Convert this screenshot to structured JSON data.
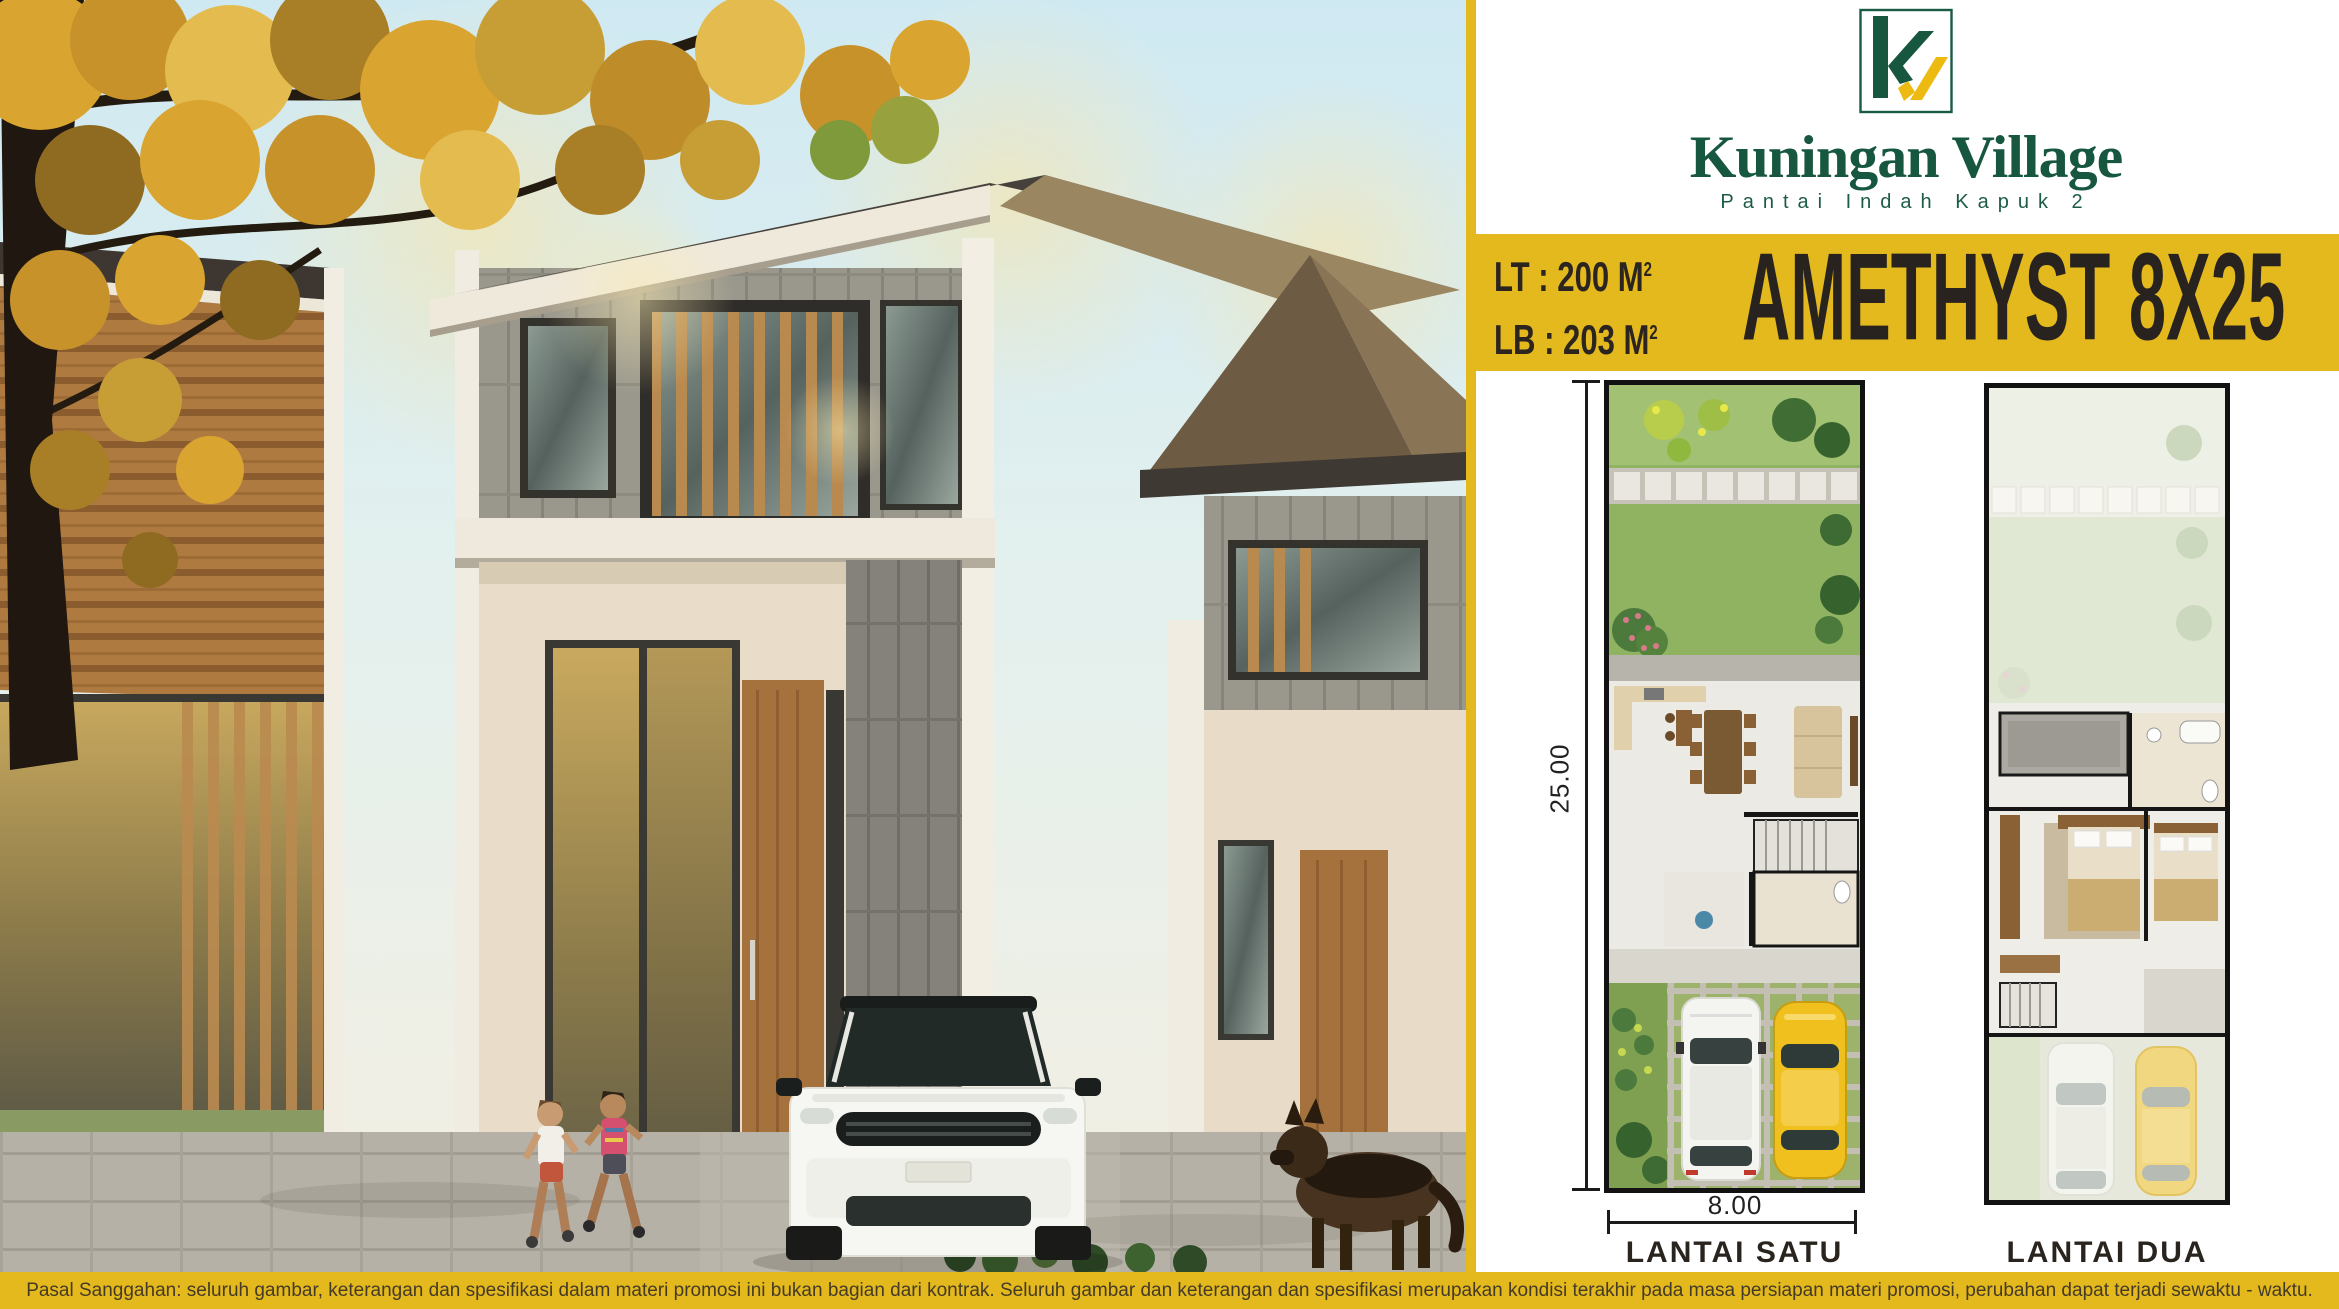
{
  "brand": {
    "name": "Kuningan Village",
    "tagline": "Pantai Indah Kapuk 2",
    "monogram": "kv"
  },
  "colors": {
    "brand_green": "#175740",
    "logo_yellow": "#EDBA12",
    "banner_yellow": "#E3B91E",
    "banner_text": "#2B241F"
  },
  "banner": {
    "lt_label": "LT : 200 M",
    "lt_sup": "2",
    "lb_label": "LB : 203 M",
    "lb_sup": "2",
    "title": "AMETHYST 8X25"
  },
  "floorplans": {
    "plan1": {
      "label": "LANTAI SATU",
      "depth_dim": "25.00",
      "width_dim": "8.00"
    },
    "plan2": {
      "label": "LANTAI DUA"
    }
  },
  "disclaimer": "Pasal Sanggahan: seluruh gambar, keterangan dan spesifikasi dalam materi promosi ini bukan bagian dari kontrak. Seluruh gambar dan keterangan dan spesifikasi merupakan kondisi terakhir pada masa persiapan materi promosi, perubahan dapat terjadi sewaktu - waktu."
}
